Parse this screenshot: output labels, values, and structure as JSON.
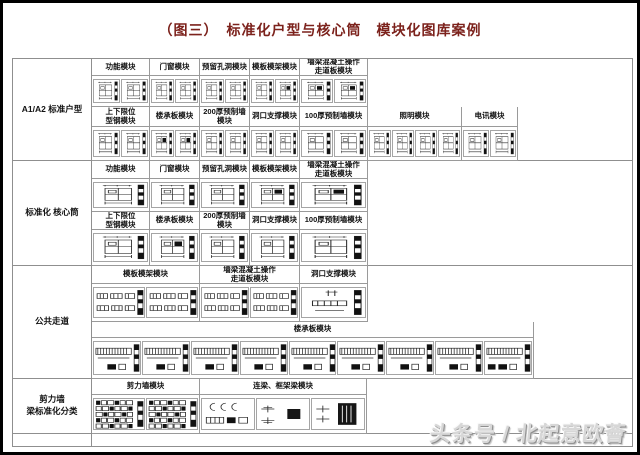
{
  "page": {
    "title": "（图三）　标准化户型与核心筒　模块化图库案例",
    "title_color": "#7c221c"
  },
  "watermark": {
    "text": "头条号 / 北起意欧薈"
  },
  "sections": [
    {
      "label": "A1/A2 标准户型",
      "rows": [
        {
          "cells": [
            {
              "label": "功能模块",
              "drawings": [
                "plan",
                "plan"
              ]
            },
            {
              "label": "门窗模块",
              "drawings": [
                "plan",
                "plan"
              ]
            },
            {
              "label": "预留孔洞模块",
              "drawings": [
                "plan",
                "plan"
              ]
            },
            {
              "label": "模板模架模块",
              "drawings": [
                "plan",
                "planD"
              ]
            },
            {
              "label": "墙梁混凝土操作\n走道板模块",
              "drawings": [
                "planD",
                "planD"
              ]
            }
          ]
        },
        {
          "cells": [
            {
              "label": "上下限位\n型钢模块",
              "drawings": [
                "plan",
                "plan"
              ]
            },
            {
              "label": "楼承板模块",
              "drawings": [
                "planD",
                "planD"
              ]
            },
            {
              "label": "200厚预制墙模块",
              "drawings": [
                "plan",
                "plan"
              ]
            },
            {
              "label": "洞口支撑模块",
              "drawings": [
                "plan",
                "plan"
              ]
            },
            {
              "label": "100厚预制墙模块",
              "drawings": [
                "plan",
                "plan"
              ]
            },
            {
              "label": "照明模块",
              "drawings": [
                "plan",
                "plan",
                "plan",
                "plan"
              ]
            },
            {
              "label": "电讯模块",
              "drawings": [
                "plan",
                "plan"
              ]
            }
          ]
        }
      ]
    },
    {
      "label": "标准化 核心筒",
      "rows": [
        {
          "cells": [
            {
              "label": "功能模块",
              "drawings": [
                "plan"
              ]
            },
            {
              "label": "门窗模块",
              "drawings": [
                "plan"
              ]
            },
            {
              "label": "预留孔洞模块",
              "drawings": [
                "plan"
              ]
            },
            {
              "label": "模板模架模块",
              "drawings": [
                "planD"
              ]
            },
            {
              "label": "墙梁混凝土操作\n走道板模块",
              "drawings": [
                "planD"
              ]
            }
          ]
        },
        {
          "cells": [
            {
              "label": "上下限位\n型钢模块",
              "drawings": [
                "plan"
              ]
            },
            {
              "label": "楼承板模块",
              "drawings": [
                "planD"
              ]
            },
            {
              "label": "200厚预制墙模块",
              "drawings": [
                "plan"
              ]
            },
            {
              "label": "洞口支撑模块",
              "drawings": [
                "plan"
              ]
            },
            {
              "label": "100厚预制墙模块",
              "drawings": [
                "plan"
              ]
            }
          ]
        }
      ]
    },
    {
      "label": "公共走道",
      "rows": [
        {
          "cells": [
            {
              "label": "模板模架模块",
              "drawings": [
                "bars",
                "bars"
              ]
            },
            {
              "label": "墙梁混凝土操作\n走道板模块",
              "drawings": [
                "bars",
                "bars"
              ]
            },
            {
              "label": "洞口支撑模块",
              "drawings": [
                "slabS"
              ]
            }
          ]
        },
        {
          "cells": [
            {
              "label": "楼承板模块",
              "drawings": [
                "slab",
                "slab",
                "slab",
                "slab",
                "slab",
                "slab",
                "slab",
                "slab",
                "slabD"
              ]
            }
          ]
        }
      ]
    },
    {
      "label": "剪力墙\n梁标准化分类",
      "rows": [
        {
          "cells": [
            {
              "label": "剪力墙模块",
              "drawings": [
                "stack",
                "stack"
              ]
            },
            {
              "label": "连梁、框架梁模块",
              "drawings": [
                "clamps",
                "beamblock",
                "beamblockD"
              ]
            }
          ]
        }
      ]
    }
  ]
}
